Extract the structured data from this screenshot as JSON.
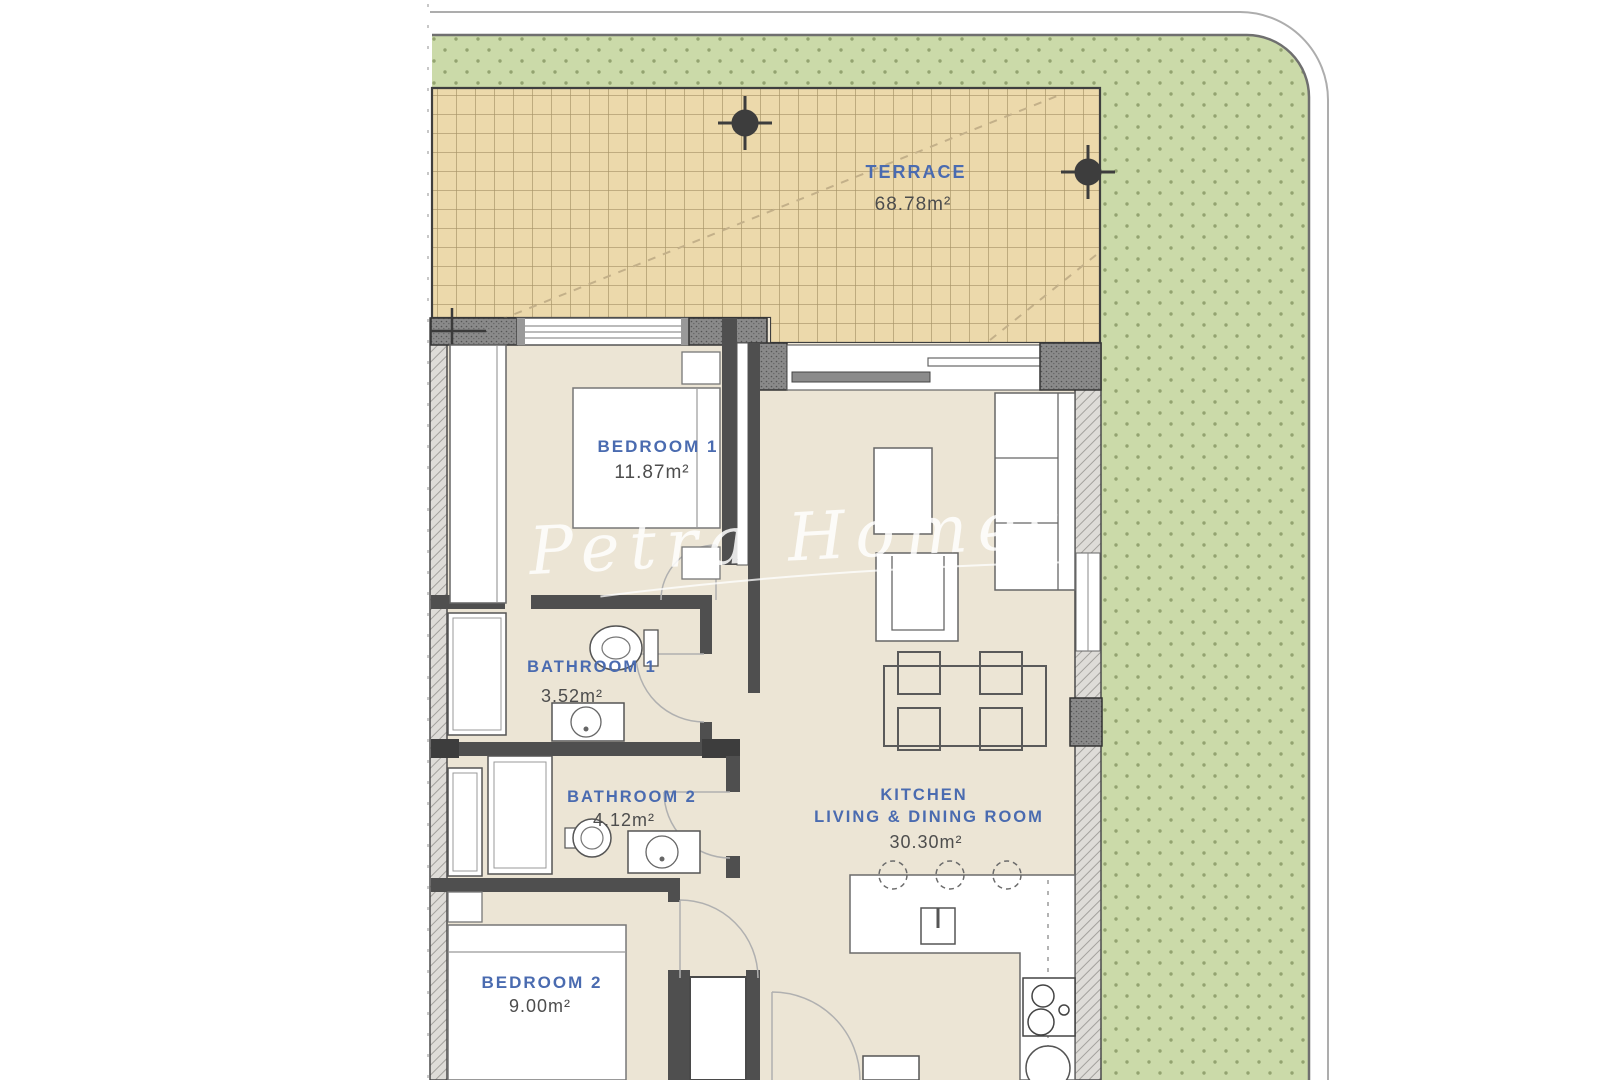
{
  "plan": {
    "type": "apartment-floor-plan",
    "rooms": {
      "terrace": {
        "label": "TERRACE",
        "area": "68.78m²"
      },
      "bedroom1": {
        "label": "BEDROOM  1",
        "area": "11.87m²"
      },
      "bathroom1": {
        "label": "BATHROOM  1",
        "area": "3.52m²"
      },
      "bathroom2": {
        "label": "BATHROOM  2",
        "area": "4.12m²"
      },
      "bedroom2": {
        "label": "BEDROOM  2",
        "area": "9.00m²"
      },
      "kitchen_living": {
        "label_line1": "KITCHEN",
        "label_line2": "LIVING  &  DINING  ROOM",
        "area": "30.30m²"
      }
    },
    "watermark": {
      "text": "Petra Homes"
    },
    "colors": {
      "page_bg": "#ffffff",
      "lawn": "#cbdaa9",
      "lawn_dot": "#849562",
      "terrace_fill": "#ecd9ab",
      "terrace_grid": "#8f7b4e",
      "floor": "#ece5d5",
      "wall_dark": "#4f4f4f",
      "wall_hatch": "#d8d6d2",
      "room_label_blue": "#4a6bb0",
      "area_text": "#4d4d4d",
      "watermark_white": "#ffffff"
    }
  }
}
